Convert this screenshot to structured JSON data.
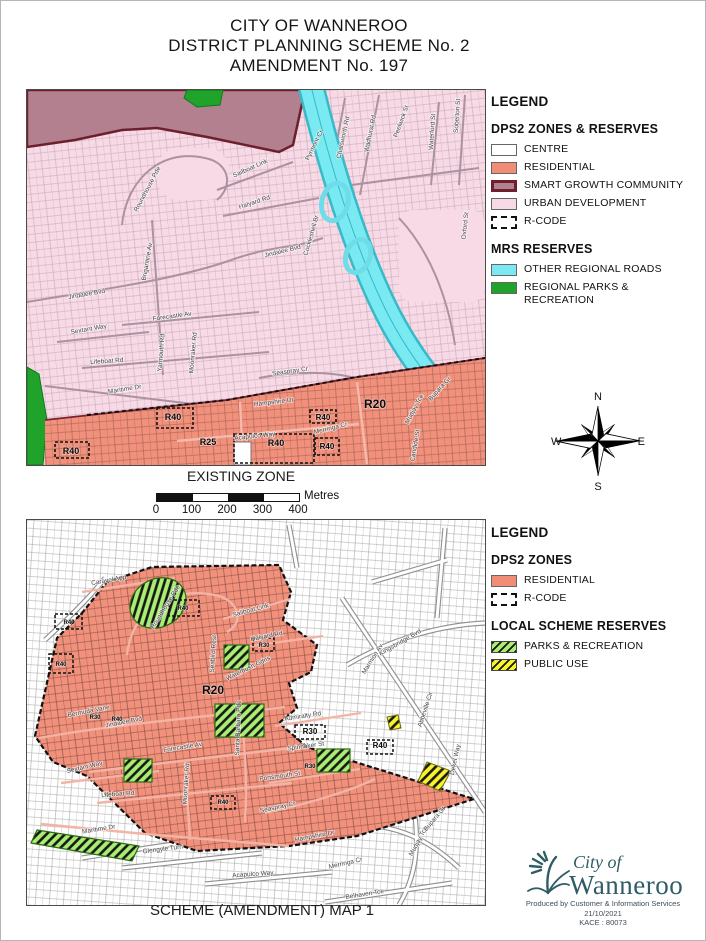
{
  "title": {
    "line1": "CITY OF WANNEROO",
    "line2": "DISTRICT PLANNING SCHEME No. 2",
    "line3": "AMENDMENT No. 197"
  },
  "legend1": {
    "heading": "LEGEND",
    "zones_title": "DPS2 ZONES & RESERVES",
    "zones": [
      {
        "label": "CENTRE",
        "swatch": "centre"
      },
      {
        "label": "RESIDENTIAL",
        "swatch": "residential"
      },
      {
        "label": "SMART GROWTH COMMUNITY",
        "swatch": "smart_growth"
      },
      {
        "label": "URBAN DEVELOPMENT",
        "swatch": "urban_development"
      },
      {
        "label": "R-CODE",
        "swatch": "rcode"
      }
    ],
    "mrs_title": "MRS RESERVES",
    "mrs": [
      {
        "label": "OTHER REGIONAL ROADS",
        "swatch": "regional_roads"
      },
      {
        "label": "REGIONAL PARKS & RECREATION",
        "swatch": "regional_parks"
      }
    ]
  },
  "legend2": {
    "heading": "LEGEND",
    "zones_title": "DPS2 ZONES",
    "zones": [
      {
        "label": "RESIDENTIAL",
        "swatch": "residential"
      },
      {
        "label": "R-CODE",
        "swatch": "rcode"
      }
    ],
    "local_title": "LOCAL SCHEME RESERVES",
    "local": [
      {
        "label": "PARKS & RECREATION",
        "swatch": "parks_recreation"
      },
      {
        "label": "PUBLIC USE",
        "swatch": "public_use"
      }
    ]
  },
  "compass": {
    "n": "N",
    "s": "S",
    "e": "E",
    "w": "W"
  },
  "scalebar": {
    "unit": "Metres",
    "ticks": [
      "0",
      "100",
      "200",
      "300",
      "400"
    ]
  },
  "map1": {
    "caption": "EXISTING ZONE",
    "streets": [
      {
        "t": "Roundhouse Pde",
        "x": 122,
        "y": 100,
        "r": -62
      },
      {
        "t": "Sailboat Link",
        "x": 224,
        "y": 80,
        "r": -24
      },
      {
        "t": "Halyard Rd",
        "x": 228,
        "y": 114,
        "r": -18
      },
      {
        "t": "Pyrmont Cr",
        "x": 289,
        "y": 56,
        "r": -64
      },
      {
        "t": "Chatsworth Rd",
        "x": 318,
        "y": 48,
        "r": -78
      },
      {
        "t": "Wadhurst Rd",
        "x": 345,
        "y": 44,
        "r": -78
      },
      {
        "t": "Peelwick St",
        "x": 376,
        "y": 32,
        "r": -70
      },
      {
        "t": "Waterford St",
        "x": 407,
        "y": 42,
        "r": -86
      },
      {
        "t": "Soberton St",
        "x": 432,
        "y": 26,
        "r": -86
      },
      {
        "t": "Brigantine Av",
        "x": 122,
        "y": 172,
        "r": -80
      },
      {
        "t": "Jindalee Bvd",
        "x": 60,
        "y": 206,
        "r": -10
      },
      {
        "t": "Jindalee Bvd",
        "x": 256,
        "y": 163,
        "r": -14
      },
      {
        "t": "Oxford St",
        "x": 440,
        "y": 136,
        "r": -84
      },
      {
        "t": "Cockleshell Br",
        "x": 286,
        "y": 146,
        "r": -74
      },
      {
        "t": "Forecastle Av.",
        "x": 146,
        "y": 228,
        "r": -8
      },
      {
        "t": "Sextant Way",
        "x": 62,
        "y": 241,
        "r": -10
      },
      {
        "t": "Yarmouth Rd",
        "x": 136,
        "y": 263,
        "r": -85
      },
      {
        "t": "Moonraker Rd",
        "x": 168,
        "y": 263,
        "r": -85
      },
      {
        "t": "Lifeboat Rd",
        "x": 80,
        "y": 273,
        "r": -4
      },
      {
        "t": "Maritime Dr",
        "x": 98,
        "y": 301,
        "r": -9
      },
      {
        "t": "Seaspray Cr.",
        "x": 264,
        "y": 283,
        "r": -8
      },
      {
        "t": "Hampshire Dr",
        "x": 247,
        "y": 314,
        "r": -7
      },
      {
        "t": "Acapulco Way",
        "x": 228,
        "y": 348,
        "r": -6
      },
      {
        "t": "Merringa Cr",
        "x": 304,
        "y": 340,
        "r": -14
      },
      {
        "t": "Mudjay Tce",
        "x": 389,
        "y": 320,
        "r": -62
      },
      {
        "t": "Bupara Gr",
        "x": 414,
        "y": 300,
        "r": -48
      },
      {
        "t": "Candide St",
        "x": 390,
        "y": 356,
        "r": -80
      }
    ],
    "rcodes": [
      {
        "t": "R40",
        "x": 44,
        "y": 364,
        "s": 9
      },
      {
        "t": "R40",
        "x": 146,
        "y": 330,
        "s": 9
      },
      {
        "t": "R25",
        "x": 181,
        "y": 355,
        "s": 9
      },
      {
        "t": "R40",
        "x": 249,
        "y": 356,
        "s": 9
      },
      {
        "t": "R40",
        "x": 296,
        "y": 330,
        "s": 8
      },
      {
        "t": "R40",
        "x": 300,
        "y": 359,
        "s": 8
      },
      {
        "t": "R20",
        "x": 348,
        "y": 318,
        "s": 12
      }
    ]
  },
  "map2": {
    "caption": "SCHEME (AMENDMENT) MAP 1",
    "streets": [
      {
        "t": "Caravel App",
        "x": 82,
        "y": 62,
        "r": -10
      },
      {
        "t": "Roundhouse Pde",
        "x": 140,
        "y": 88,
        "r": -58
      },
      {
        "t": "Sailboat Link",
        "x": 224,
        "y": 92,
        "r": -15
      },
      {
        "t": "Halyard Rd",
        "x": 240,
        "y": 118,
        "r": -11
      },
      {
        "t": "Seabird Rest",
        "x": 188,
        "y": 134,
        "r": -86
      },
      {
        "t": "Waterbush Gdns",
        "x": 222,
        "y": 150,
        "r": -26
      },
      {
        "t": "Bermuda Vane",
        "x": 62,
        "y": 193,
        "r": -11
      },
      {
        "t": "Jindalee Bvd",
        "x": 97,
        "y": 204,
        "r": -11
      },
      {
        "t": "Forecastle Av",
        "x": 156,
        "y": 229,
        "r": -9
      },
      {
        "t": "Sextant Way",
        "x": 58,
        "y": 249,
        "r": -13
      },
      {
        "t": "Moonraker Rd",
        "x": 161,
        "y": 264,
        "r": -86
      },
      {
        "t": "Santa Barbara Pde",
        "x": 213,
        "y": 208,
        "r": -88
      },
      {
        "t": "Lifeboat Rd",
        "x": 91,
        "y": 276,
        "r": -4
      },
      {
        "t": "Maritime Dr",
        "x": 72,
        "y": 311,
        "r": -9
      },
      {
        "t": "Admiralty Rd",
        "x": 276,
        "y": 198,
        "r": -9
      },
      {
        "t": "Spinnaker St",
        "x": 279,
        "y": 228,
        "r": -8
      },
      {
        "t": "Portsmouth St",
        "x": 253,
        "y": 258,
        "r": -8
      },
      {
        "t": "Seaspray Cr",
        "x": 251,
        "y": 289,
        "r": -12
      },
      {
        "t": "Kingsbridge Bvd",
        "x": 374,
        "y": 124,
        "r": -30
      },
      {
        "t": "Marmion Av",
        "x": 347,
        "y": 140,
        "r": -58
      },
      {
        "t": "Abbeville Cir",
        "x": 400,
        "y": 190,
        "r": -72
      },
      {
        "t": "Dekel Way",
        "x": 430,
        "y": 240,
        "r": -78
      },
      {
        "t": "Hampshire Dr",
        "x": 288,
        "y": 318,
        "r": -11
      },
      {
        "t": "Glengyle Turn",
        "x": 136,
        "y": 331,
        "r": -7
      },
      {
        "t": "Acapulco Way",
        "x": 226,
        "y": 356,
        "r": -4
      },
      {
        "t": "Merringa Cr",
        "x": 319,
        "y": 345,
        "r": -13
      },
      {
        "t": "Belhaven Tce",
        "x": 338,
        "y": 376,
        "r": -9
      },
      {
        "t": "Mudjay Tce",
        "x": 393,
        "y": 322,
        "r": -62
      },
      {
        "t": "Bupara Gr",
        "x": 409,
        "y": 300,
        "r": -50
      }
    ],
    "rcodes": [
      {
        "t": "R20",
        "x": 186,
        "y": 174,
        "s": 12
      },
      {
        "t": "R30",
        "x": 283,
        "y": 214,
        "s": 8
      },
      {
        "t": "R40",
        "x": 353,
        "y": 228,
        "s": 8
      },
      {
        "t": "R40",
        "x": 156,
        "y": 90,
        "s": 6
      },
      {
        "t": "R40",
        "x": 42,
        "y": 104,
        "s": 6
      },
      {
        "t": "R40",
        "x": 34,
        "y": 146,
        "s": 6
      },
      {
        "t": "R30",
        "x": 68,
        "y": 199,
        "s": 6
      },
      {
        "t": "R40",
        "x": 90,
        "y": 201,
        "s": 6
      },
      {
        "t": "R30",
        "x": 237,
        "y": 127,
        "s": 6
      },
      {
        "t": "R30",
        "x": 283,
        "y": 248,
        "s": 6
      },
      {
        "t": "R40",
        "x": 196,
        "y": 284,
        "s": 6
      }
    ]
  },
  "logo": {
    "line1": "City of",
    "line2": "Wanneroo",
    "produced": "Produced by Customer & Information Services",
    "date": "21/10/2021",
    "ref": "KACE : 80073"
  },
  "colors": {
    "centre": "#ffffff",
    "residential": "#f18c77",
    "smart_growth": "#b2808f",
    "smart_growth_border": "#6e1f2d",
    "urban_development": "#f8d9e6",
    "rcode": "#ffffff",
    "regional_roads": "#7ce9f2",
    "regional_parks": "#1fa32b",
    "parks_recreation": "#a9ee72",
    "public_use": "#f8f32b",
    "logo_teal": "#2f5d66"
  }
}
